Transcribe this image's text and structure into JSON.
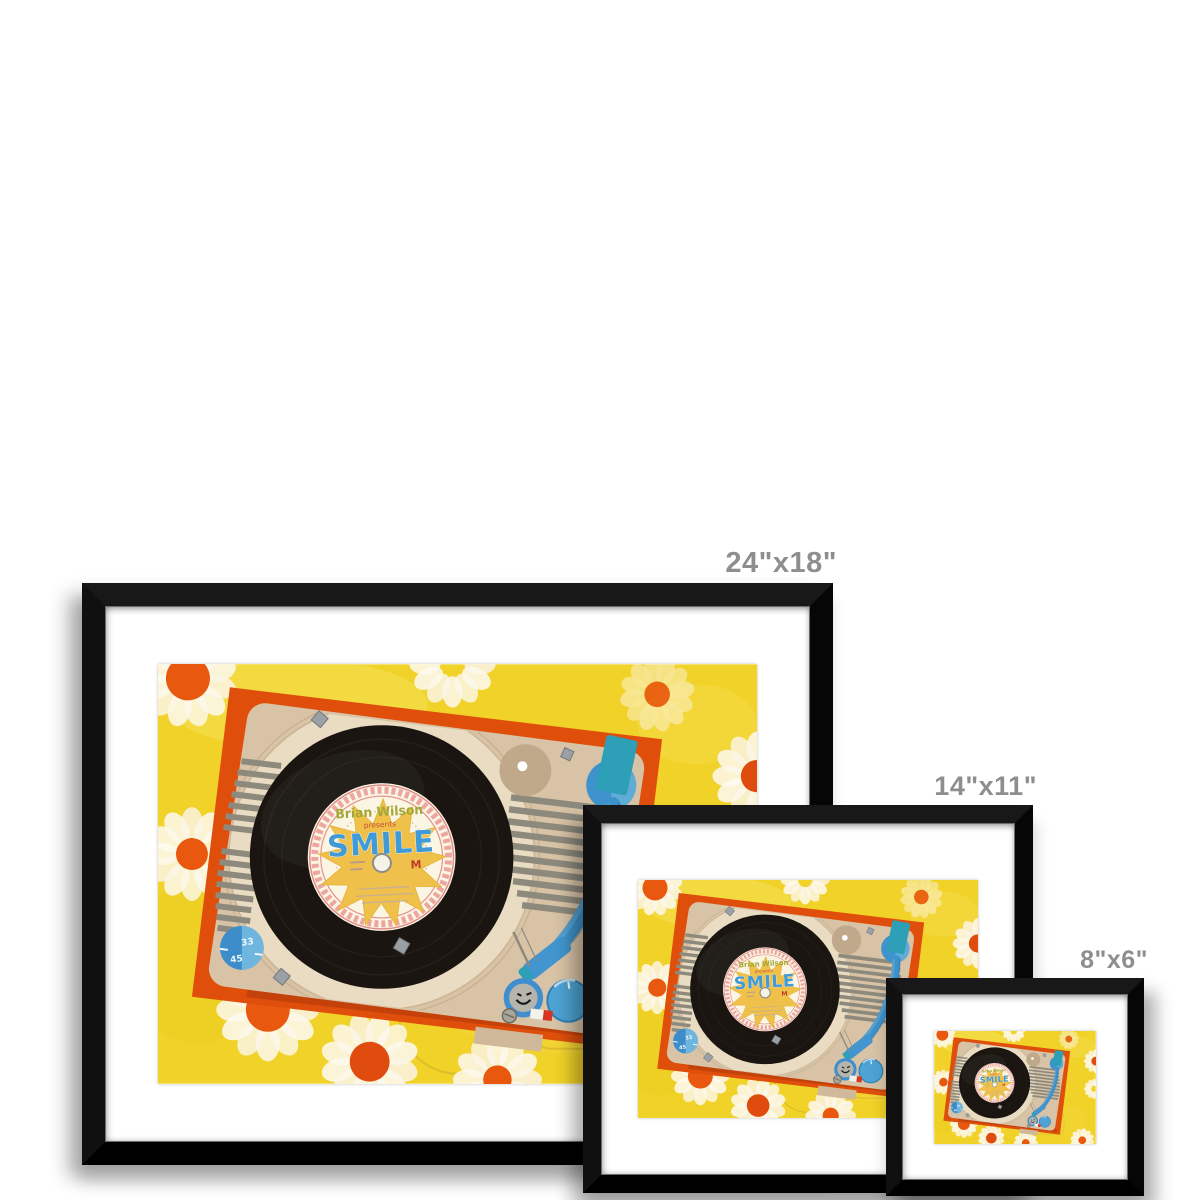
{
  "page": {
    "background": "#ffffff"
  },
  "product": {
    "frames": [
      {
        "id": "large",
        "size_label": "24\"x18\""
      },
      {
        "id": "medium",
        "size_label": "14\"x11\""
      },
      {
        "id": "small",
        "size_label": "8\"x6\""
      }
    ],
    "frame_color": "#0d0d0d",
    "mat_color": "#ffffff",
    "size_label_color": "#8e8e8e"
  },
  "artwork": {
    "record_label": {
      "artist": "Brian Wilson",
      "presents": "presents",
      "title": "SMILE",
      "mark": "M"
    },
    "speed_knob": {
      "top": "33",
      "bottom": "45"
    },
    "colors": {
      "background_yellow": "#f1d228",
      "player_orange": "#df4f0b",
      "player_orange_dark": "#c4420a",
      "deck_tan": "#d8c3a6",
      "platter_cream": "#e9dcc2",
      "record_black": "#1a1510",
      "label_cream": "#fbf5e4",
      "grille_gray": "#8d8a7d",
      "tonearm_blue": "#3f93cc",
      "teal": "#2d9fb6",
      "knob_blue": "#4da3d3",
      "daisy_white": "#fcf7e9",
      "daisy_center_orange": "#e8590f",
      "label_ring_pink": "#eca69f",
      "smile_blue": "#3f9ad5",
      "sun_yellow": "#efc04a",
      "artist_green": "#a3a838",
      "presents_red": "#c94e35"
    }
  }
}
